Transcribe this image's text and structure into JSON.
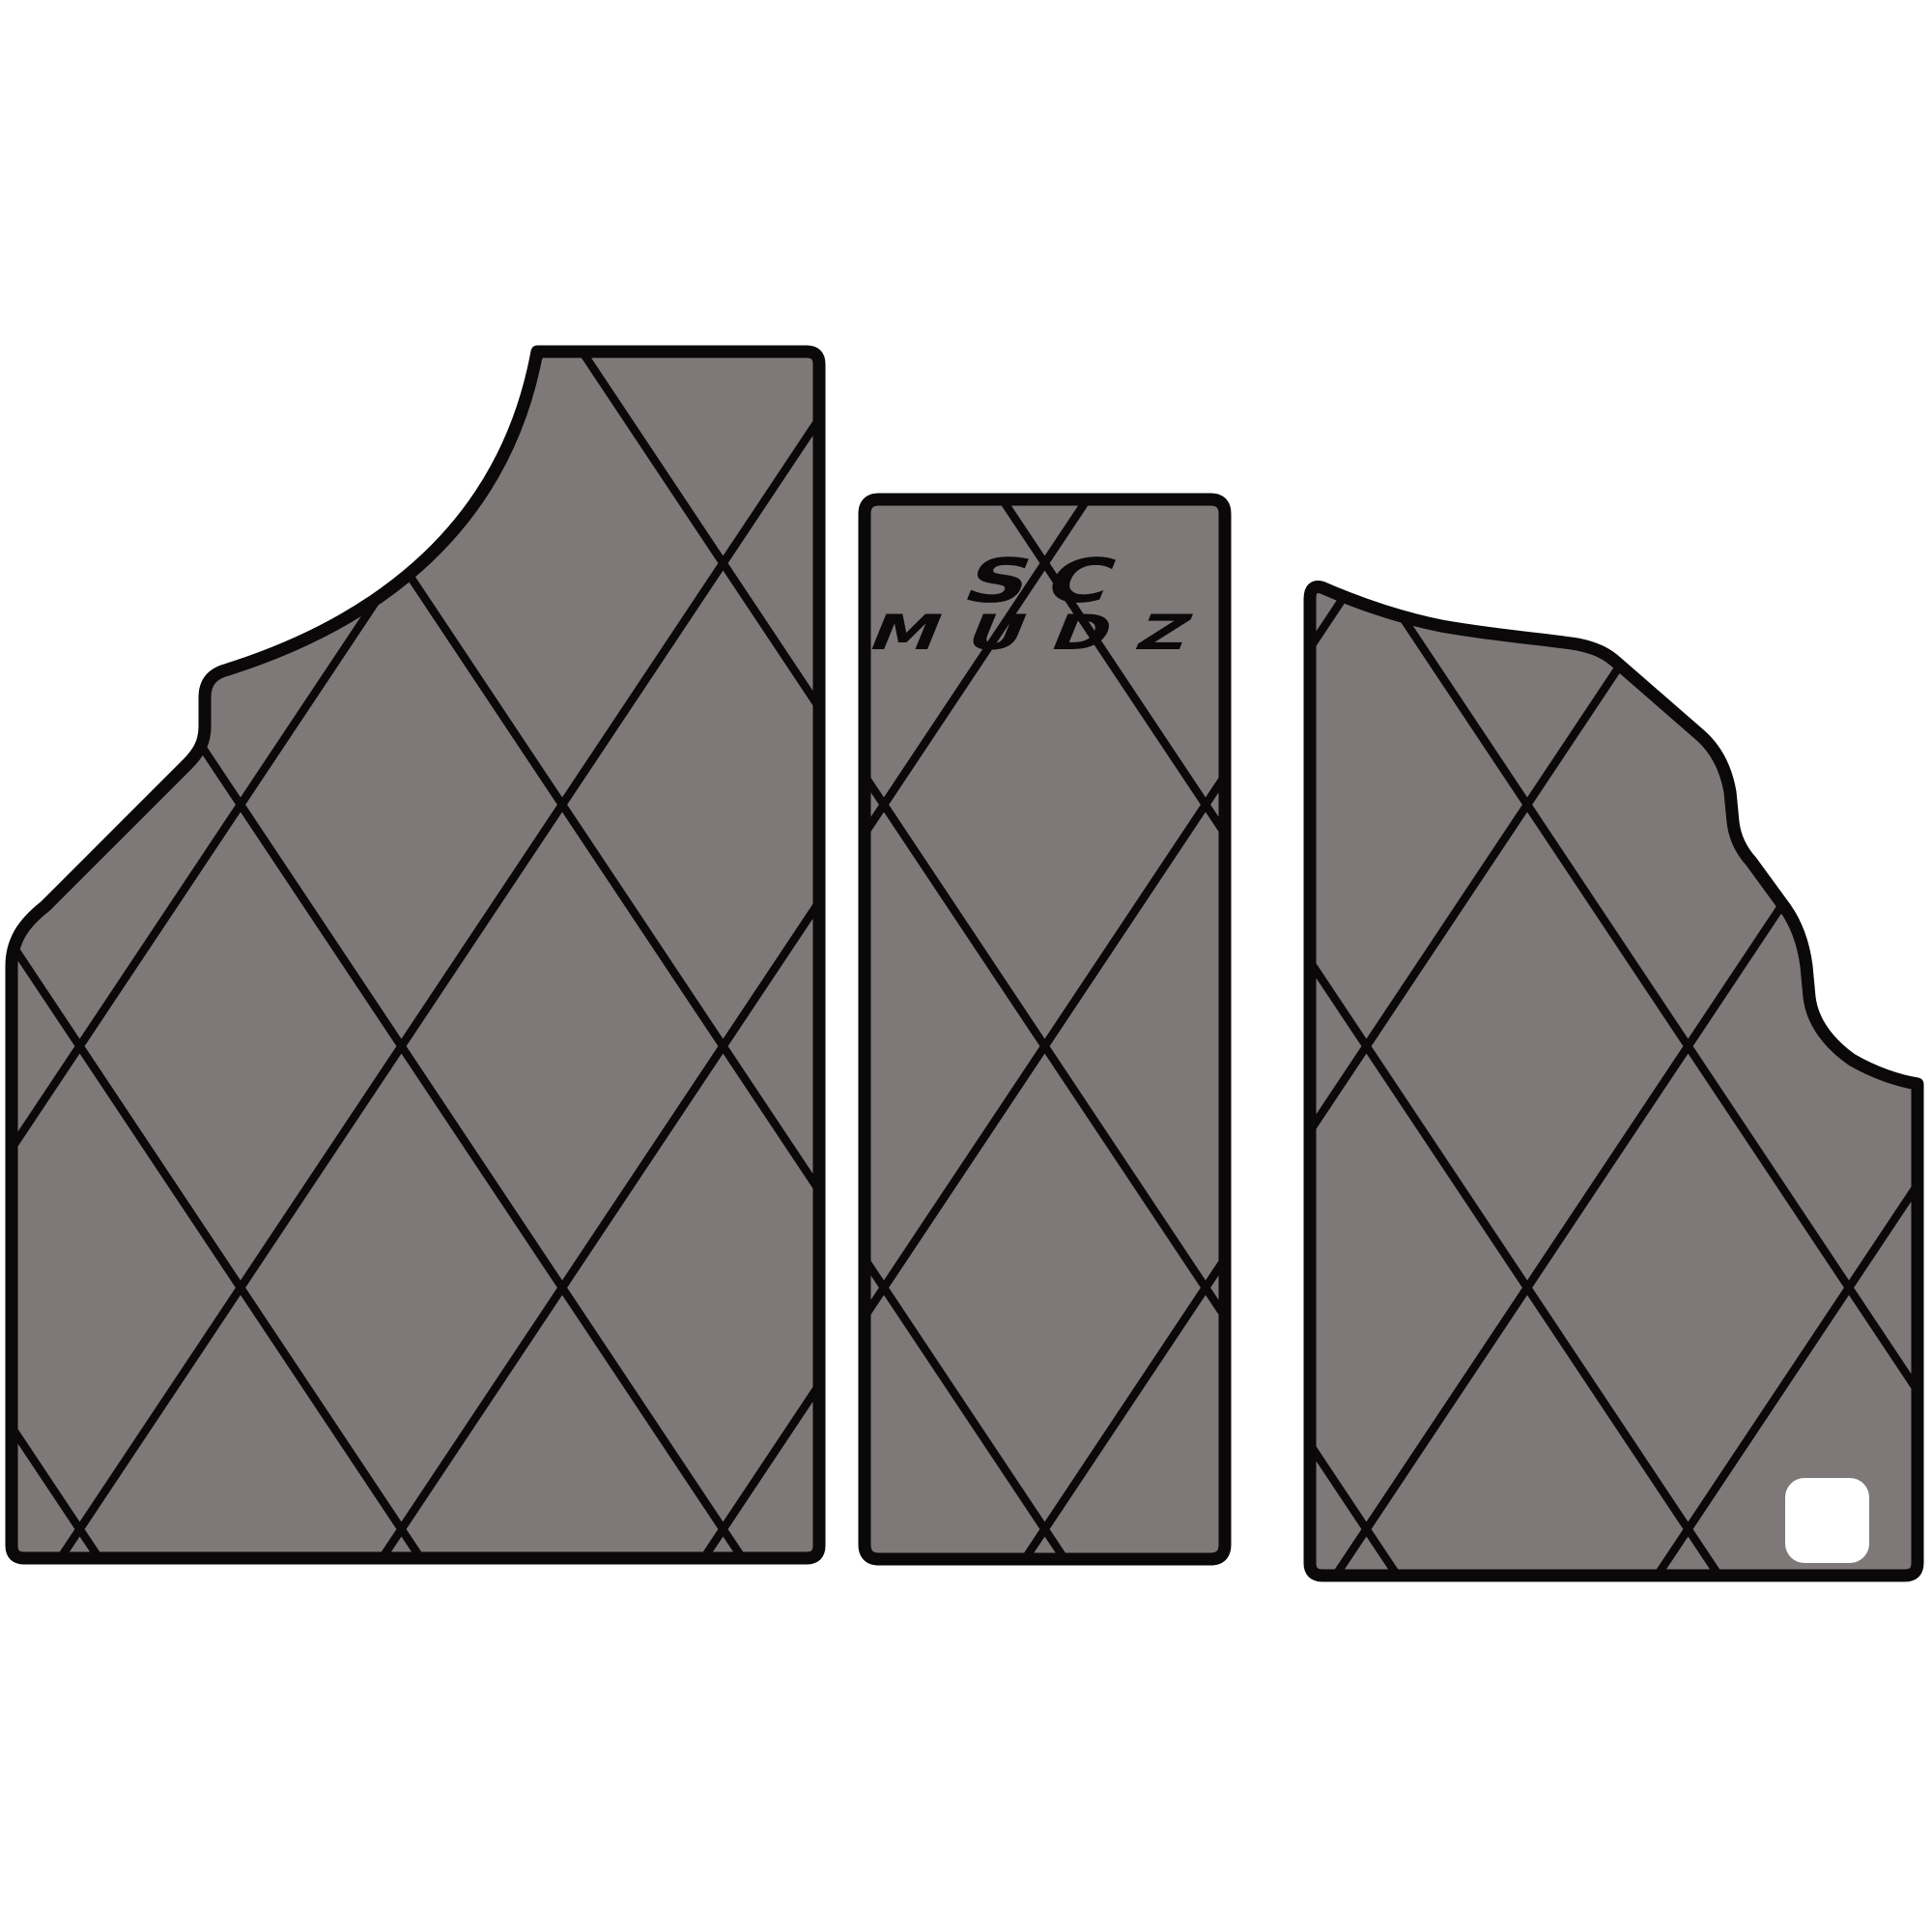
{
  "product": {
    "name": "SC MUDZ quilted floor mat set",
    "logo": {
      "line1": "SC",
      "line2": "MUDZ",
      "color": "#0a0808"
    }
  },
  "colors": {
    "background": "#ffffff",
    "mat_gray": "#7f7878",
    "outline": "#0a0808",
    "patch_white": "#ffffff"
  },
  "panels": [
    {
      "id": "driver-mat"
    },
    {
      "id": "console-mat"
    },
    {
      "id": "passenger-mat"
    }
  ]
}
